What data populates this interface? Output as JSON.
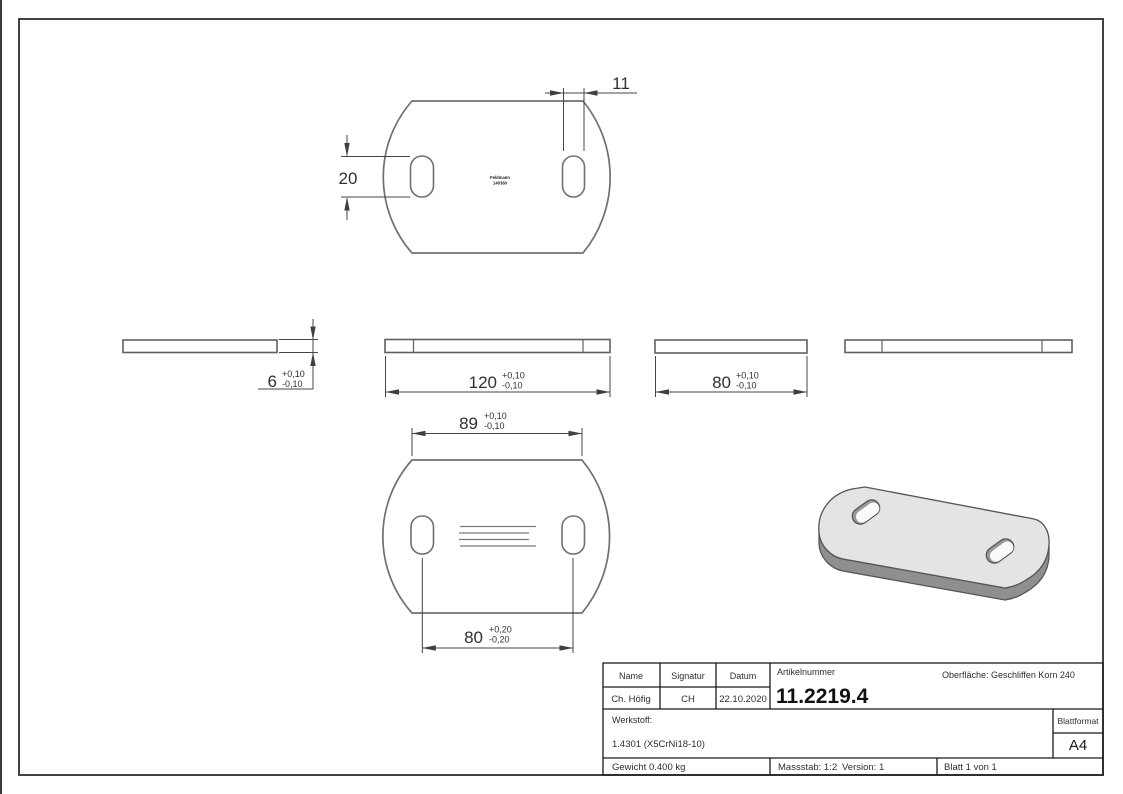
{
  "sheet": {
    "stamp": {
      "line1": "Feldmann",
      "line2": "140360"
    },
    "dimensions": {
      "slot_width": "11",
      "slot_height": "20",
      "thickness": "6",
      "thickness_tol_plus": "+0,10",
      "thickness_tol_minus": "-0,10",
      "length": "120",
      "length_tol_plus": "+0,10",
      "length_tol_minus": "-0,10",
      "width": "80",
      "width_tol_plus": "+0,10",
      "width_tol_minus": "-0,10",
      "hole_span": "89",
      "hole_span_tol_plus": "+0,10",
      "hole_span_tol_minus": "-0,10",
      "hole_centers": "80",
      "hole_centers_tol_plus": "+0,20",
      "hole_centers_tol_minus": "-0,20"
    },
    "title_block": {
      "name_label": "Name",
      "signatur_label": "Signatur",
      "datum_label": "Datum",
      "name_value": "Ch. Höfig",
      "signatur_value": "CH",
      "datum_value": "22.10.2020",
      "artikelnummer_label": "Artikelnummer",
      "artikelnummer_value": "11.2219.4",
      "oberflaeche_text": "Oberfläche:  Geschliffen Korn 240",
      "werkstoff_label": "Werkstoff:",
      "werkstoff_value": "1.4301 (X5CrNi18-10)",
      "gewicht_text": "Gewicht 0.400 kg",
      "massstab_text": "Massstab: 1:2",
      "version_text": "Version: 1",
      "blatt_text": "Blatt 1 von 1",
      "blattformat_label": "Blattformat",
      "blattformat_value": "A4"
    },
    "colors": {
      "outline": "#707070",
      "dim_line": "#454545",
      "frame": "#2e2e2e",
      "iso_top_face": "#e4e4e4",
      "iso_side_face": "#8f8f8f"
    }
  }
}
